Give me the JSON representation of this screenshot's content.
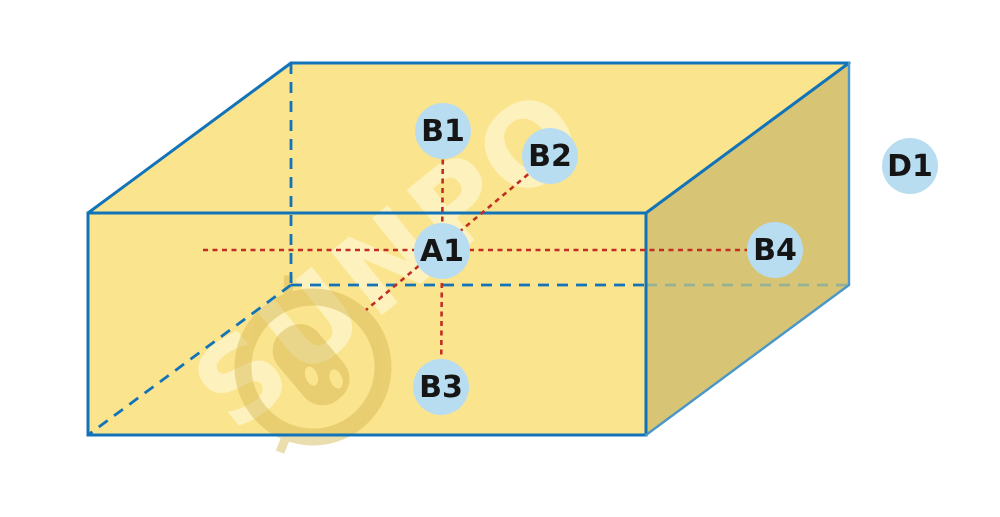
{
  "diagram": {
    "description": "cuboid-with-labeled-points",
    "points": [
      {
        "id": "A1",
        "label": "A1",
        "x": 442,
        "y": 251
      },
      {
        "id": "B1",
        "label": "B1",
        "x": 443,
        "y": 131
      },
      {
        "id": "B2",
        "label": "B2",
        "x": 550,
        "y": 156
      },
      {
        "id": "B3",
        "label": "B3",
        "x": 441,
        "y": 387
      },
      {
        "id": "B4",
        "label": "B4",
        "x": 775,
        "y": 250
      },
      {
        "id": "D1",
        "label": "D1",
        "x": 910,
        "y": 166
      }
    ],
    "guide_lines": [
      {
        "name": "horizontal",
        "x1": 203,
        "y1": 250,
        "x2": 775,
        "y2": 250
      },
      {
        "name": "vertical",
        "x1": 443,
        "y1": 131,
        "x2": 441,
        "y2": 387
      },
      {
        "name": "diagonal",
        "x1": 550,
        "y1": 156,
        "x2": 366,
        "y2": 310
      }
    ]
  },
  "watermark": {
    "text": "SUNPO"
  },
  "colors": {
    "face-light": "#FBE48E",
    "face-dark": "#D7C475",
    "edge-blue": "#1273B8",
    "edge-blue-light": "#4A97C8",
    "hidden-on-dark": "#97B194",
    "guide-red": "#C02E24",
    "point-fill": "#B9DDF0",
    "point-text": "#151515"
  }
}
